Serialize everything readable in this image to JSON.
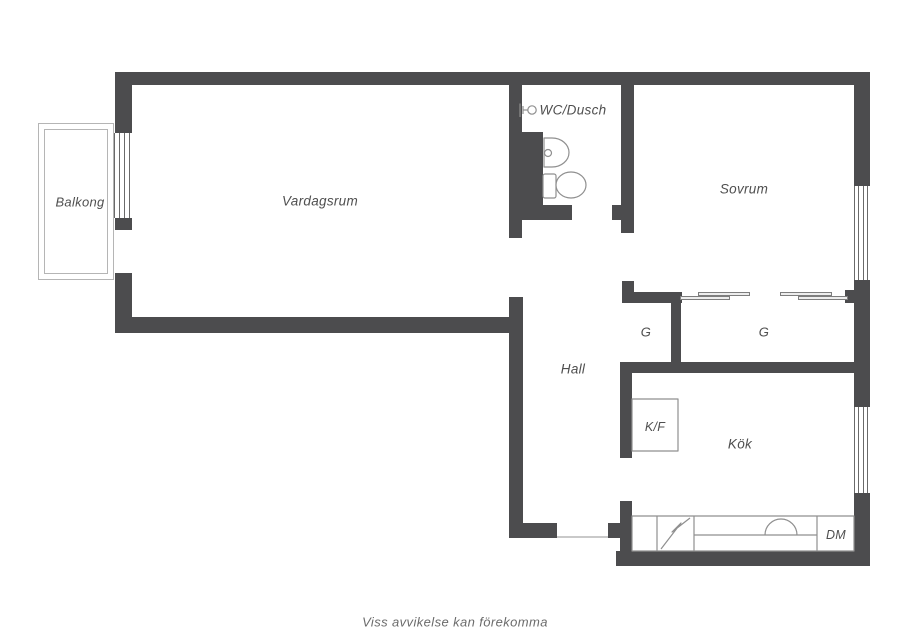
{
  "footer": {
    "text": "Viss avvikelse kan förekomma"
  },
  "colors": {
    "wall": "#4c4c4e",
    "fixture_line": "#8f8f8f",
    "balcony_line": "#b5b5b5",
    "window_line": "#6a6a6a",
    "threshold": "#c9c9c9",
    "label_text": "#4f4f4f",
    "background": "#ffffff"
  },
  "floorplan": {
    "canvas": {
      "w": 905,
      "h": 640
    },
    "walls": [
      [
        115,
        72,
        755,
        13
      ],
      [
        115,
        72,
        17,
        61
      ],
      [
        115,
        218,
        17,
        12
      ],
      [
        115,
        273,
        17,
        60
      ],
      [
        115,
        317,
        408,
        16
      ],
      [
        509,
        297,
        14,
        241
      ],
      [
        509,
        523,
        48,
        15
      ],
      [
        509,
        85,
        13,
        153
      ],
      [
        522,
        132,
        21,
        88
      ],
      [
        509,
        205,
        63,
        15
      ],
      [
        612,
        205,
        10,
        15
      ],
      [
        621,
        85,
        13,
        148
      ],
      [
        622,
        281,
        12,
        12
      ],
      [
        622,
        292,
        60,
        11
      ],
      [
        845,
        290,
        9,
        13
      ],
      [
        671,
        302,
        10,
        60
      ],
      [
        620,
        362,
        234,
        11
      ],
      [
        854,
        72,
        16,
        114
      ],
      [
        854,
        280,
        16,
        127
      ],
      [
        854,
        493,
        16,
        73
      ],
      [
        616,
        551,
        254,
        15
      ],
      [
        620,
        373,
        12,
        85
      ],
      [
        620,
        501,
        12,
        55
      ],
      [
        608,
        523,
        12,
        15
      ]
    ],
    "windows": [
      {
        "name": "balcony-door-window",
        "x": 114,
        "y": 133,
        "w": 16,
        "h": 85,
        "lines": 4
      },
      {
        "name": "sovrum-window",
        "x": 854,
        "y": 186,
        "w": 14,
        "h": 94,
        "lines": 4
      },
      {
        "name": "kok-window",
        "x": 854,
        "y": 407,
        "w": 14,
        "h": 86,
        "lines": 4
      }
    ],
    "balcony": {
      "outer": [
        38,
        123,
        76,
        157
      ],
      "inner": [
        44,
        129,
        64,
        145
      ]
    },
    "threshold": {
      "name": "entry-door-threshold",
      "x": 557,
      "y": 536,
      "w": 51,
      "h": 2
    },
    "sliding_panels": [
      {
        "x": 698,
        "y": 292,
        "w": 52,
        "h": 4
      },
      {
        "x": 680,
        "y": 296,
        "w": 50,
        "h": 4
      },
      {
        "x": 780,
        "y": 292,
        "w": 52,
        "h": 4
      },
      {
        "x": 798,
        "y": 296,
        "w": 50,
        "h": 4
      }
    ],
    "fixtures": [
      {
        "name": "kitchen-counter",
        "type": "rect",
        "x": 632,
        "y": 516,
        "w": 222,
        "h": 35,
        "fill": true
      },
      {
        "name": "counter-divider",
        "type": "line",
        "x1": 657,
        "y1": 516,
        "x2": 657,
        "y2": 551
      },
      {
        "name": "counter-divider",
        "type": "line",
        "x1": 694,
        "y1": 516,
        "x2": 694,
        "y2": 551
      },
      {
        "name": "counter-divider",
        "type": "line",
        "x1": 817,
        "y1": 516,
        "x2": 817,
        "y2": 551
      },
      {
        "name": "counter-line",
        "type": "line",
        "x1": 694,
        "y1": 535,
        "x2": 817,
        "y2": 535
      },
      {
        "name": "kitchen-sink",
        "type": "path",
        "d": "M765,535 A16,16 0 0 1 797,535"
      },
      {
        "name": "stove-icon",
        "type": "path",
        "d": "M661,549 L681,523 L672,532 L690,518"
      },
      {
        "name": "fridge-freezer-box",
        "type": "rect",
        "x": 632,
        "y": 399,
        "w": 46,
        "h": 52,
        "fill": true
      },
      {
        "name": "toilet-tank",
        "type": "rect",
        "x": 543,
        "y": 174,
        "w": 13,
        "h": 24,
        "rx": 2,
        "fill": true
      },
      {
        "name": "toilet-bowl",
        "type": "ellipse",
        "cx": 571,
        "cy": 185,
        "rx": 15,
        "ry": 13,
        "fill": true
      },
      {
        "name": "bathroom-sink",
        "type": "path",
        "d": "M544,138 L552,138 A17,14.5 0 0 1 552,167 L544,167 Z",
        "fill": true
      },
      {
        "name": "sink-tap",
        "type": "circle",
        "cx": 548,
        "cy": 153,
        "r": 3.5,
        "fill": true
      },
      {
        "name": "shower-icon",
        "type": "path",
        "d": "M520,103.5 L520,117"
      },
      {
        "name": "shower-icon",
        "type": "path",
        "d": "M523,106 L523,114"
      },
      {
        "name": "shower-icon",
        "type": "path",
        "d": "M523,110 L528,110"
      },
      {
        "name": "shower-icon",
        "type": "circle",
        "cx": 532,
        "cy": 110,
        "r": 4.2,
        "fill": true
      }
    ],
    "labels": [
      {
        "name": "room-label-balkong",
        "text": "Balkong",
        "x": 80,
        "y": 202,
        "size": 13
      },
      {
        "name": "room-label-vardagsrum",
        "text": "Vardagsrum",
        "x": 320,
        "y": 201,
        "size": 13.5
      },
      {
        "name": "room-label-wc-dusch",
        "text": "WC/Dusch",
        "x": 573,
        "y": 110,
        "size": 13.5
      },
      {
        "name": "room-label-sovrum",
        "text": "Sovrum",
        "x": 744,
        "y": 189,
        "size": 13.5
      },
      {
        "name": "room-label-hall",
        "text": "Hall",
        "x": 573,
        "y": 369,
        "size": 13.5
      },
      {
        "name": "closet-label-g-small",
        "text": "G",
        "x": 646,
        "y": 332,
        "size": 13
      },
      {
        "name": "closet-label-g-large",
        "text": "G",
        "x": 764,
        "y": 332,
        "size": 13
      },
      {
        "name": "appliance-label-kf",
        "text": "K/F",
        "x": 655,
        "y": 427,
        "size": 12.5
      },
      {
        "name": "room-label-kok",
        "text": "Kök",
        "x": 740,
        "y": 444,
        "size": 13.5
      },
      {
        "name": "appliance-label-dm",
        "text": "DM",
        "x": 836,
        "y": 535,
        "size": 12.5
      }
    ]
  }
}
